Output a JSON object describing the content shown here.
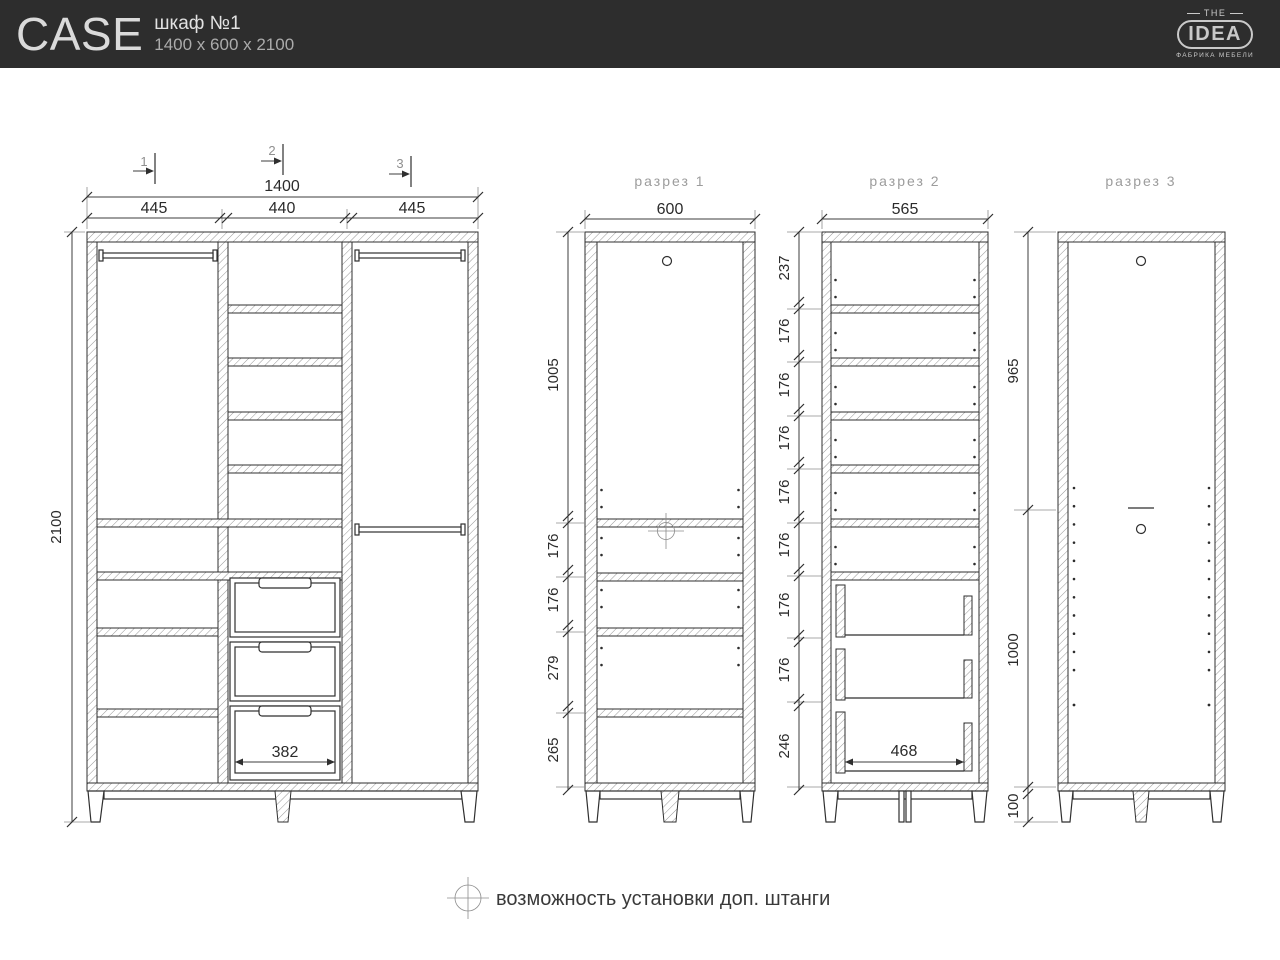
{
  "header": {
    "product_name": "CASE",
    "product_subtitle": "шкаф №1",
    "product_dimensions": "1400 x 600 x 2100",
    "logo_top": "THE",
    "logo_main": "IDEA",
    "logo_subtitle": "ФАБРИКА МЕБЕЛИ"
  },
  "front_view": {
    "marker_1": "1",
    "marker_2": "2",
    "marker_3": "3",
    "dim_total_width": "1400",
    "dim_col_left": "445",
    "dim_col_mid": "440",
    "dim_col_right": "445",
    "dim_height": "2100",
    "dim_drawer_front": "382"
  },
  "section_1": {
    "title": "разрез 1",
    "dim_depth": "600",
    "chain": [
      "1005",
      "176",
      "176",
      "279",
      "265"
    ]
  },
  "section_2": {
    "title": "разрез 2",
    "dim_depth": "565",
    "chain": [
      "237",
      "176",
      "176",
      "176",
      "176",
      "176",
      "176",
      "176",
      "246"
    ],
    "dim_drawer_depth": "468"
  },
  "section_3": {
    "title": "разрез 3",
    "chain": [
      "965",
      "1000",
      "100"
    ]
  },
  "note": {
    "text": "возможность установки доп. штанги"
  },
  "colors": {
    "header_bg": "#2d2d2d",
    "line": "#2f2f2f",
    "muted_label": "#9c9c9c"
  }
}
